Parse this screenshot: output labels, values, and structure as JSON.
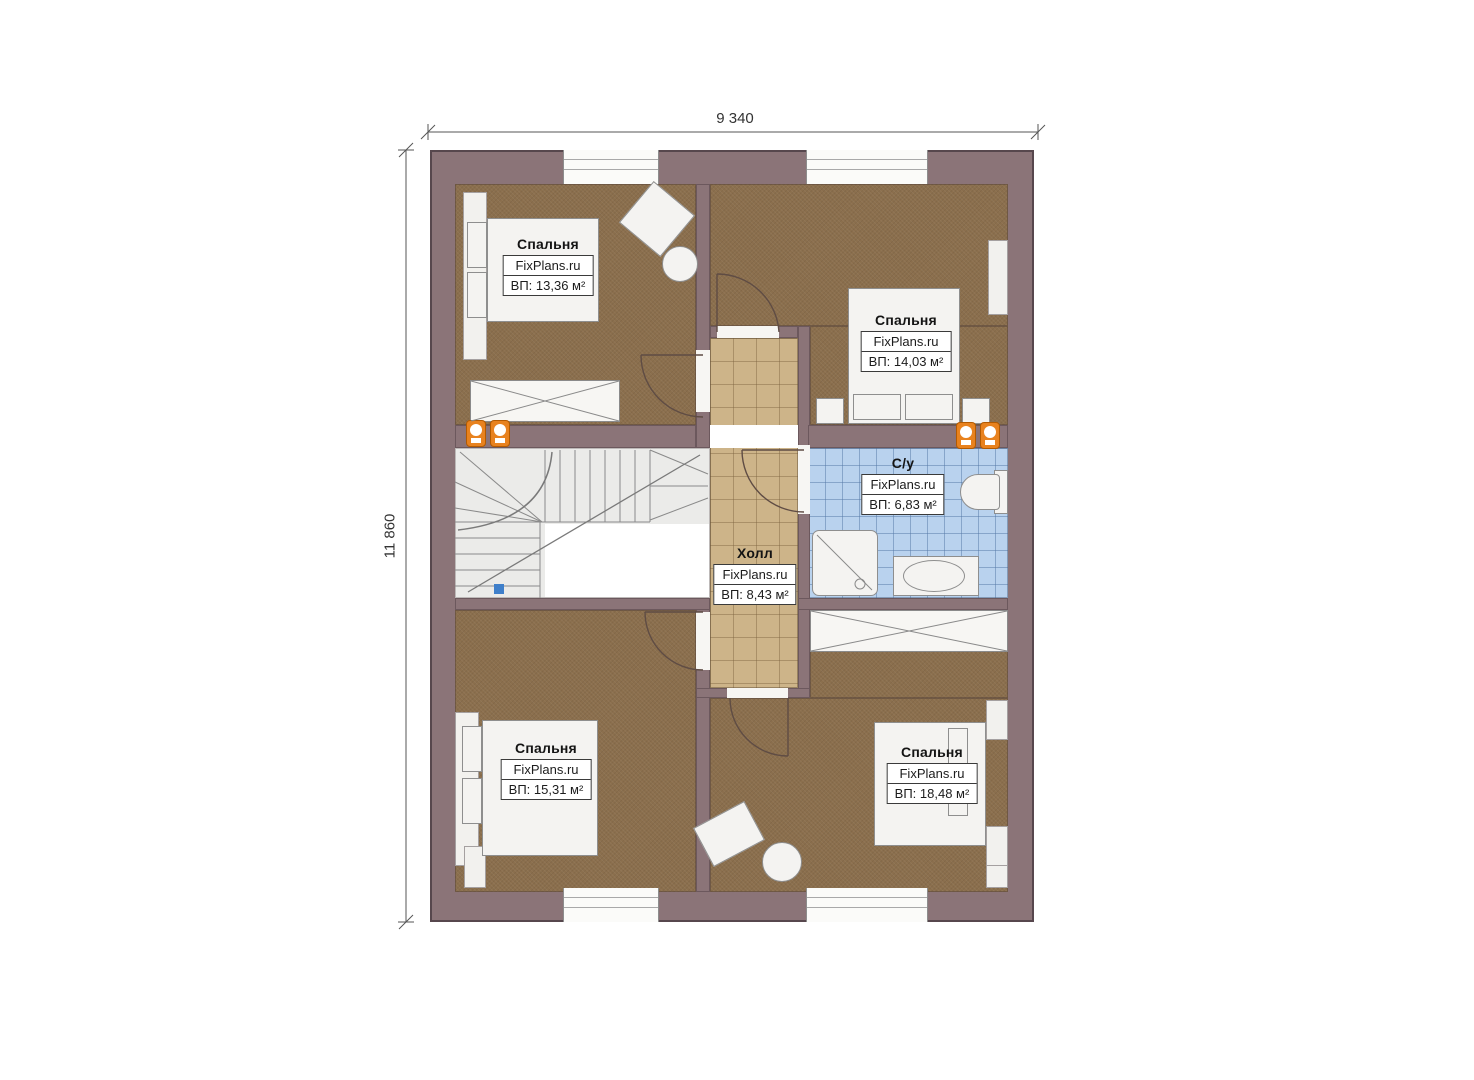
{
  "plan": {
    "dimensions": {
      "width": "9 340",
      "height": "11 860"
    },
    "rooms": [
      {
        "name": "Спальня",
        "brand": "FixPlans.ru",
        "area": "ВП: 13,36 м²"
      },
      {
        "name": "Спальня",
        "brand": "FixPlans.ru",
        "area": "ВП: 14,03 м²"
      },
      {
        "name": "С/у",
        "brand": "FixPlans.ru",
        "area": "ВП: 6,83 м²"
      },
      {
        "name": "Холл",
        "brand": "FixPlans.ru",
        "area": "ВП: 8,43 м²"
      },
      {
        "name": "Спальня",
        "brand": "FixPlans.ru",
        "area": "ВП: 15,31 м²"
      },
      {
        "name": "Спальня",
        "brand": "FixPlans.ru",
        "area": "ВП: 18,48 м²"
      }
    ],
    "colors": {
      "wall": "#8b7478",
      "bedroom_floor": "#8b6f4d",
      "hall_floor": "#cdb489",
      "bath_floor": "#b9d2ee",
      "stairs": "#ebebe9",
      "radiator": "#e8821e"
    }
  }
}
